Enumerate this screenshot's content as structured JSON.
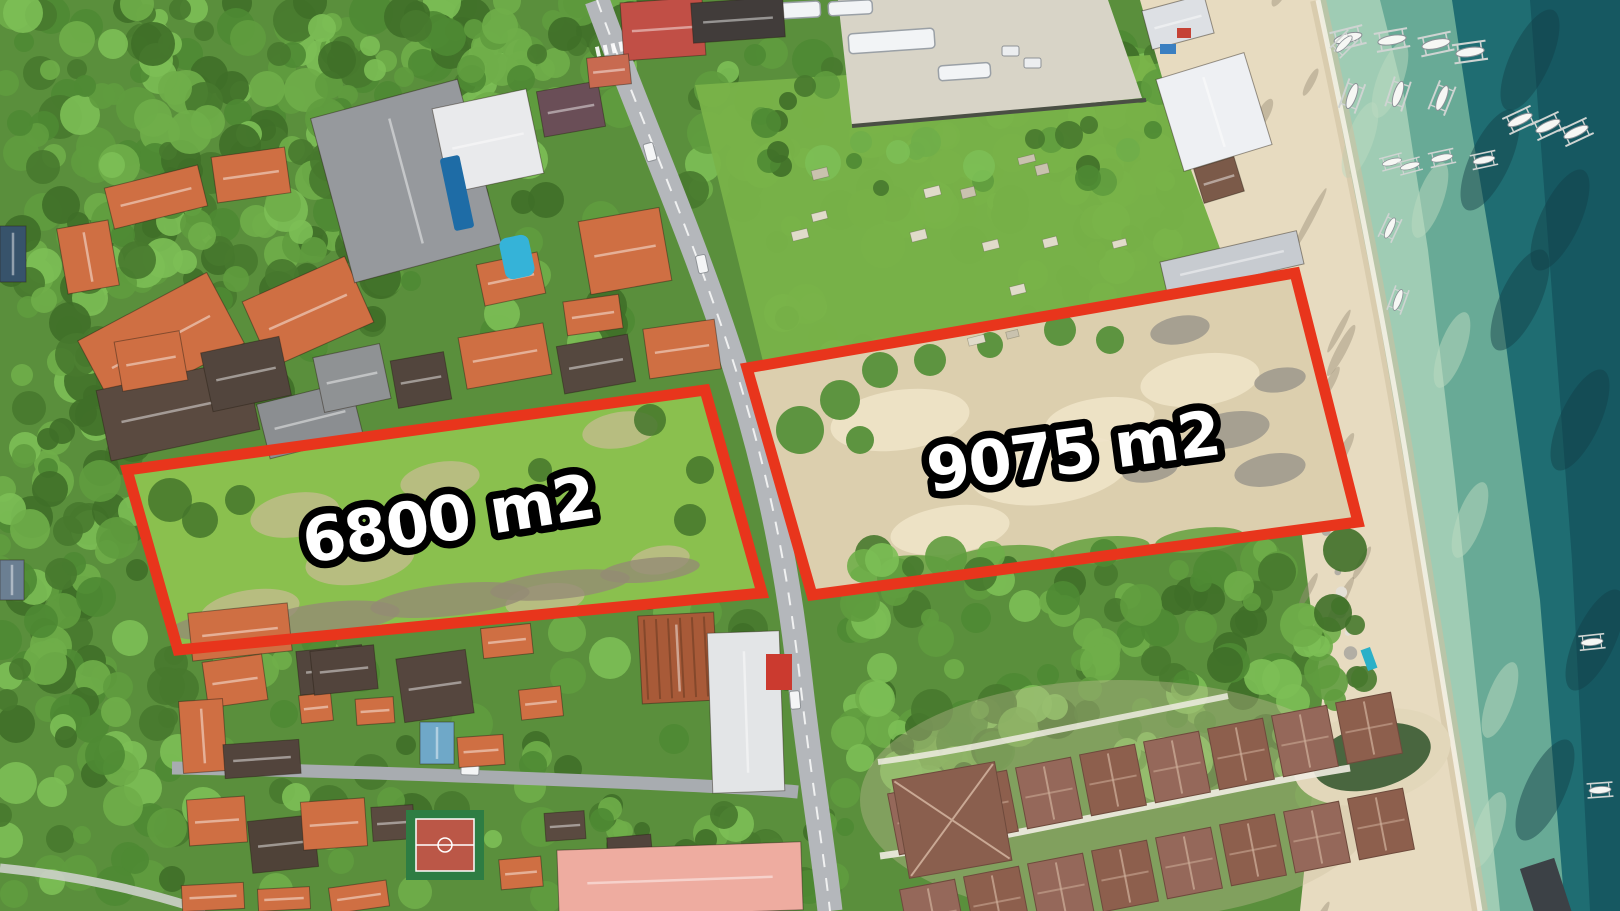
{
  "image_type": "aerial-drone-photo",
  "plots": [
    {
      "id": "plot-6800",
      "label": "6800 m2",
      "area_m2": 6800
    },
    {
      "id": "plot-9075",
      "label": "9075 m2",
      "area_m2": 9075
    }
  ],
  "colors": {
    "outline_red": "#e8351c",
    "label_fill": "#ffffff",
    "label_stroke": "#000000",
    "base_green": "#5a8f3c",
    "forest_dark": "#3f6f28",
    "forest_mid": "#4e8a33",
    "forest_light": "#6fae49",
    "forest_bright": "#7cbf55",
    "lawn_green": "#79b349",
    "plot_grass": "#8ac04e",
    "plot_sand": "#dccfae",
    "beach_sand": "#e7dbc0",
    "wet_sand": "#cdbf9e",
    "sea_shallow": "#9fccb4",
    "sea_mid": "#5ea391",
    "sea_deep": "#1f6d72",
    "sea_darkest": "#14525c",
    "road_gray": "#b4b7bb",
    "street_gray": "#a8acb0",
    "roof_orange": "#cf6f43",
    "roof_orange_lt": "#e08a54",
    "roof_dark": "#52453d",
    "roof_gray": "#96999d",
    "roof_white": "#e9eaec",
    "roof_red_landmark": "#c14f46",
    "roof_rust": "#a85a38",
    "roof_pink": "#eeaca0",
    "roof_resort": "#8d5f4d",
    "pool_blue": "#35b3d8",
    "lap_pool_blue": "#1e6ca6",
    "court_green": "#2e7d43",
    "court_red": "#bb5747",
    "pond_green": "#49663f",
    "boat_white": "#f6f7f4",
    "grave_pale": "#e0dbca"
  },
  "scene_features": [
    "forest-canopy",
    "village-roofs",
    "main-road",
    "village-street",
    "cemetery",
    "bus-parking",
    "beach-sand",
    "shallow-water",
    "deep-water",
    "outrigger-boats",
    "resort-bungalows",
    "swimming-pool",
    "basketball-court",
    "pond",
    "land-plot-6800",
    "land-plot-9075"
  ]
}
